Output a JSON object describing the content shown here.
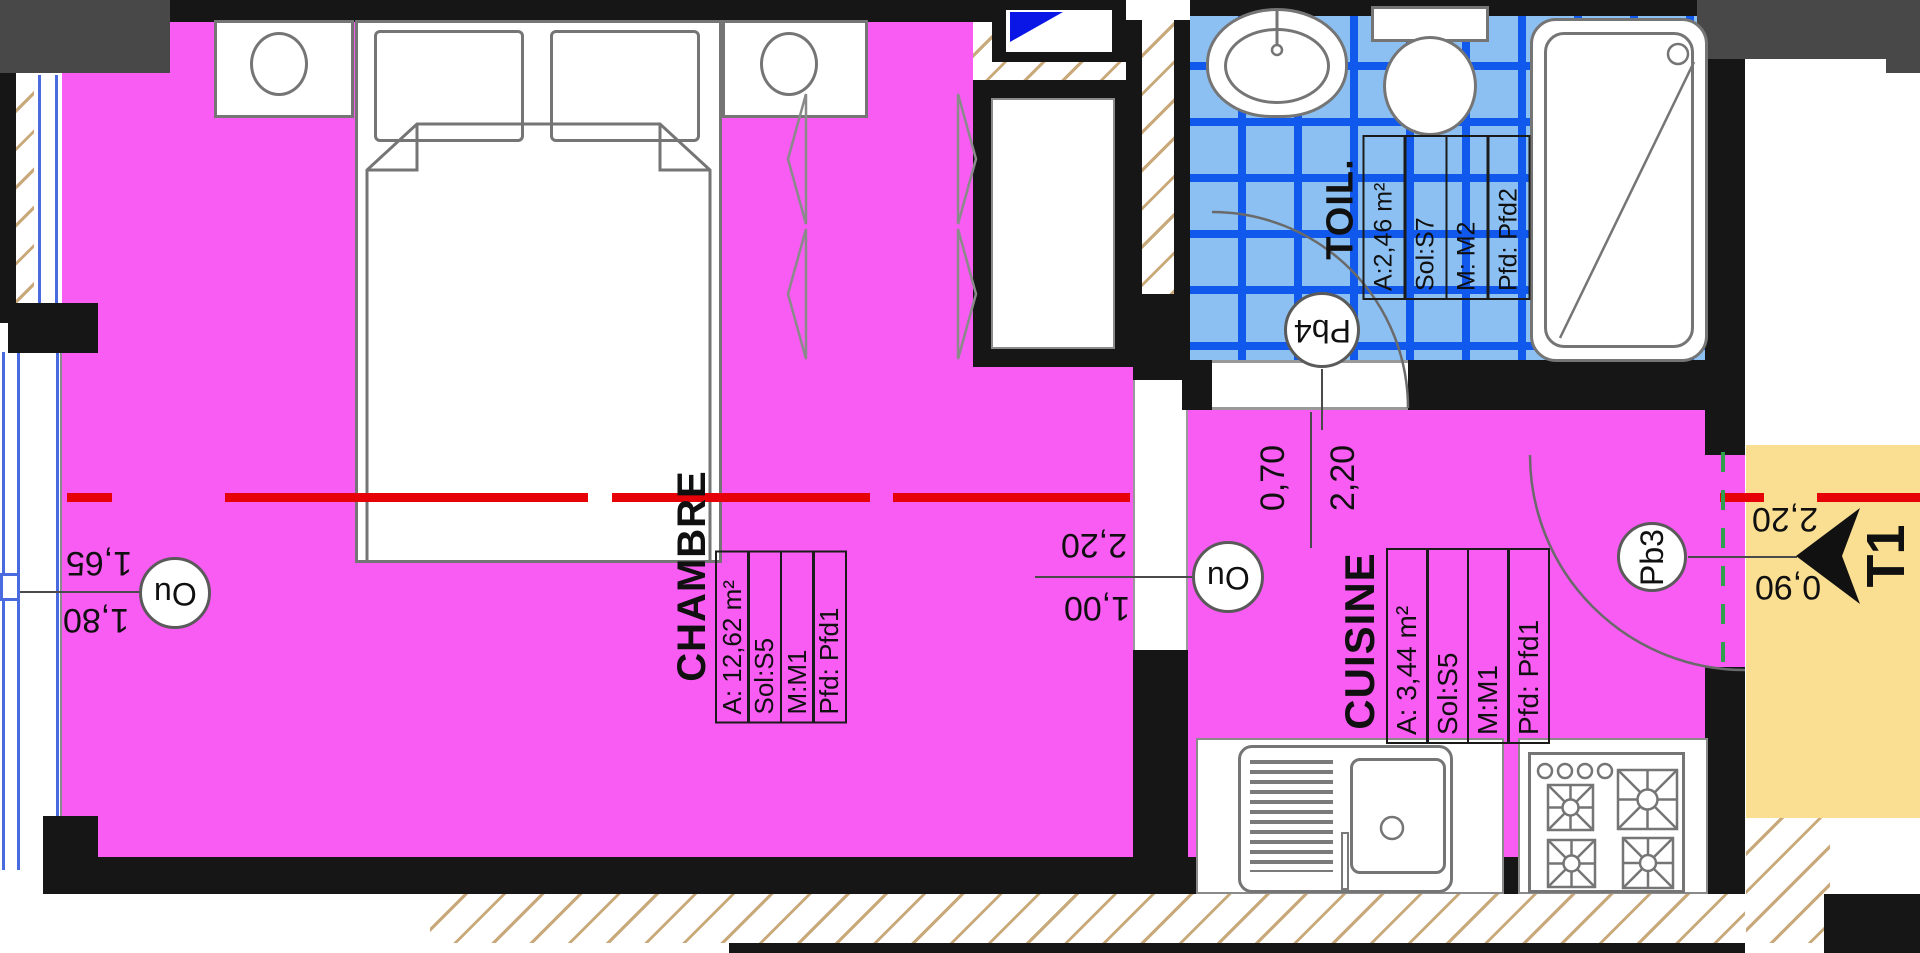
{
  "unit": {
    "label": "T1"
  },
  "rooms": [
    {
      "name": "CHAMBRE",
      "area": "A: 12,62 m²",
      "sol": "Sol:S5",
      "mur": "M:M1",
      "plafond": "Pfd: Pfd1"
    },
    {
      "name": "TOIL.",
      "area": "A:2,46 m²",
      "sol": "Sol:S7",
      "mur": "M: M2",
      "plafond": "Pfd: Pfd2"
    },
    {
      "name": "CUISINE",
      "area": "A: 3,44 m²",
      "sol": "Sol:S5",
      "mur": "M:M1",
      "plafond": "Pfd: Pfd1"
    }
  ],
  "markers": {
    "window_left": "Ou",
    "door_chambre": "Ou",
    "toilet": "Pb4",
    "entrance": "Pb3"
  },
  "dimensions": {
    "window_left": {
      "above": "1,65",
      "below": "1,80"
    },
    "door_chambre": {
      "above": "2,20",
      "below": "1,00"
    },
    "door_toilet": {
      "left": "0,70",
      "right": "2,20"
    },
    "entrance_door": {
      "above": "2,20",
      "below": "0,90"
    }
  },
  "colors": {
    "room_fill": "#F95CF3",
    "tile_fill": "#8CC0F2",
    "tile_line": "#1158EC",
    "landing_fill": "#FADF92",
    "section_line": "#E60008",
    "door_axis_line": "#2F9E4D",
    "wall": "#161616"
  }
}
